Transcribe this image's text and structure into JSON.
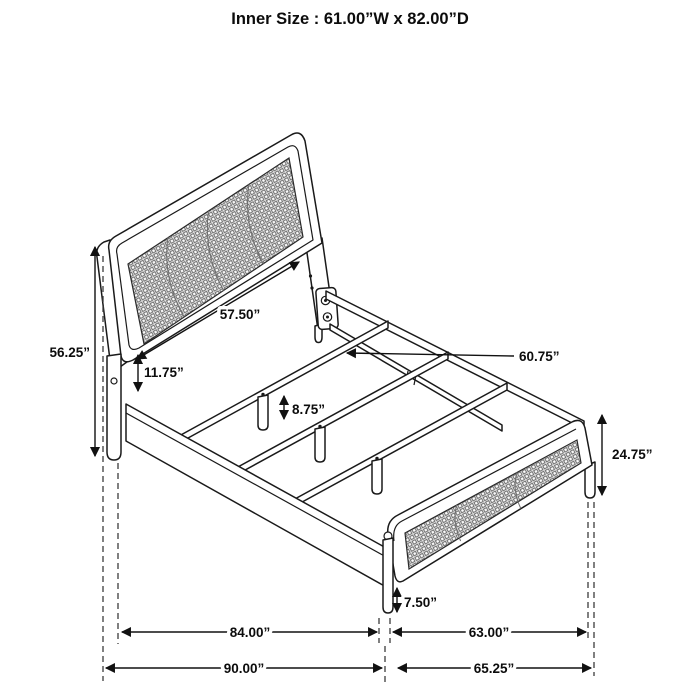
{
  "title": "Inner Size : 61.00”W x 82.00”D",
  "colors": {
    "background": "#ffffff",
    "line": "#1a1a1a",
    "mesh": "#ebebeb"
  },
  "dimensions": {
    "headboard_width": "57.50”",
    "headboard_height": "56.25”",
    "headboard_rail_gap": "11.75”",
    "slat_leg_height": "8.75”",
    "slat_length": "60.75”",
    "footboard_height": "24.75”",
    "footboard_leg_height": "7.50”",
    "frame_length_inner": "84.00”",
    "footboard_width_inner": "63.00”",
    "overall_depth": "90.00”",
    "overall_width_foot": "65.25”"
  }
}
